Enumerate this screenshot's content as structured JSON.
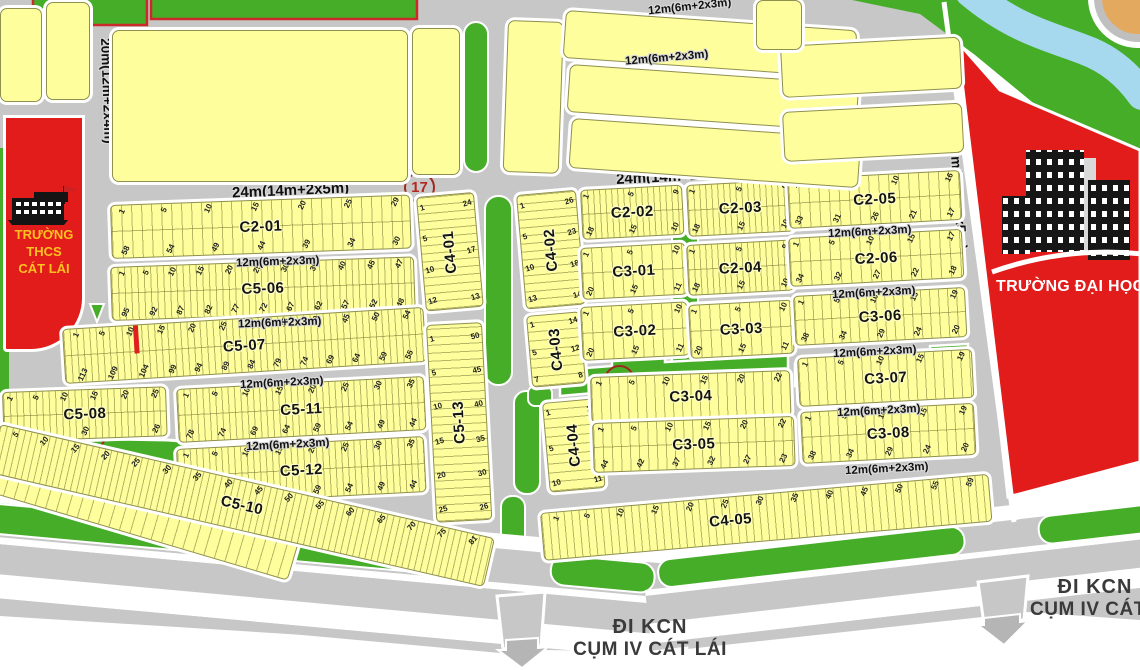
{
  "roads": {
    "r20": "20m(12m+2x4m)",
    "r24": "24m(14m+2x5m)",
    "r23": "23m(13m+2x5m)",
    "r12": "12m(6m+2x3m)",
    "street": "ĐƯỜNG SỐ 15"
  },
  "signs": {
    "kcn_line1": "ĐI KCN",
    "kcn_line2": "CỤM IV CÁT LÁI"
  },
  "schools": {
    "thcs_line1": "TRƯỜNG",
    "thcs_line2": "THCS",
    "thcs_line3": "CÁT LÁI",
    "university": "TRƯỜNG ĐẠI HỌC"
  },
  "marker": {
    "route": "17"
  },
  "colors": {
    "parcel_yellow": "#feff9c",
    "road_gray": "#c7c7c7",
    "green": "#46ad29",
    "red": "#e21b1b",
    "river_blue": "#a6d9ee",
    "sand": "#e3aa5f",
    "school_text": "#ffc21e"
  },
  "blocks": {
    "C2_01": {
      "label": "C2-01",
      "top": [
        1,
        5,
        10,
        15,
        20,
        25,
        29
      ],
      "bottom": [
        58,
        54,
        49,
        44,
        39,
        34,
        30
      ]
    },
    "C5_06": {
      "label": "C5-06",
      "top": [
        1,
        5,
        10,
        15,
        20,
        25,
        30,
        35,
        40,
        45,
        47
      ],
      "bottom": [
        95,
        92,
        87,
        82,
        77,
        72,
        67,
        62,
        57,
        52,
        48
      ]
    },
    "C5_07": {
      "label": "C5-07",
      "top": [
        1,
        5,
        10,
        15,
        20,
        25,
        30,
        35,
        40,
        45,
        50,
        54
      ],
      "bottom": [
        113,
        109,
        104,
        99,
        94,
        89,
        84,
        79,
        74,
        69,
        64,
        59,
        55
      ]
    },
    "C5_08": {
      "label": "C5-08",
      "top": [
        1,
        5,
        10,
        15,
        20,
        25
      ],
      "bottom": [
        34,
        30,
        26
      ]
    },
    "C5_09": {
      "label": "C5-09",
      "nums": [
        1,
        5,
        10,
        15,
        20,
        25,
        27
      ]
    },
    "C5_10": {
      "label": "C5-10",
      "nums": [
        5,
        10,
        15,
        20,
        25,
        30,
        35,
        40,
        45,
        50,
        55,
        60,
        65,
        70,
        75,
        81
      ]
    },
    "C5_11": {
      "label": "C5-11",
      "top": [
        1,
        5,
        10,
        15,
        20,
        25,
        30,
        35
      ],
      "bottom": [
        78,
        74,
        69,
        64,
        59,
        54,
        49,
        44
      ]
    },
    "C5_12": {
      "label": "C5-12",
      "top": [
        1,
        5,
        10,
        15,
        20,
        25,
        30,
        35
      ],
      "bottom": [
        78,
        74,
        69,
        64,
        59,
        54,
        49,
        44
      ]
    },
    "C5_13": {
      "label": "C5-13",
      "left": [
        1,
        5,
        10,
        15,
        20,
        25
      ],
      "right": [
        50,
        45,
        40,
        35,
        30,
        26
      ]
    },
    "C4_01": {
      "label": "C4-01",
      "left": [
        1,
        5,
        10,
        12
      ],
      "right": [
        24,
        17,
        13
      ]
    },
    "C4_02": {
      "label": "C4-02",
      "left": [
        1,
        5,
        10,
        13
      ],
      "right": [
        26,
        23,
        18,
        14
      ]
    },
    "C4_03": {
      "label": "C4-03",
      "left": [
        1,
        5,
        7
      ],
      "right": [
        14,
        12,
        8
      ]
    },
    "C4_04": {
      "label": "C4-04",
      "left": [
        1,
        5,
        10
      ],
      "right": [
        20,
        15,
        11
      ]
    },
    "C4_05": {
      "label": "C4-05",
      "nums": [
        1,
        5,
        10,
        15,
        20,
        25,
        30,
        35,
        40,
        45,
        50,
        55,
        59
      ]
    },
    "C2_02": {
      "label": "C2-02",
      "top": [
        1,
        5,
        9
      ],
      "bottom": [
        18,
        15,
        10
      ]
    },
    "C2_03": {
      "label": "C2-03",
      "top": [
        1,
        5,
        9
      ],
      "bottom": [
        18,
        15,
        10
      ]
    },
    "C2_04": {
      "label": "C2-04",
      "top": [
        1,
        5,
        9
      ],
      "bottom": [
        18,
        15,
        10
      ]
    },
    "C2_05": {
      "label": "C2-05",
      "top": [
        1,
        5,
        10,
        16
      ],
      "bottom": [
        33,
        31,
        26,
        21,
        17
      ]
    },
    "C2_06": {
      "label": "C2-06",
      "top": [
        1,
        5,
        10,
        15,
        17
      ],
      "bottom": [
        34,
        32,
        27,
        22,
        18
      ]
    },
    "C3_01": {
      "label": "C3-01",
      "top": [
        1,
        5,
        10
      ],
      "bottom": [
        20,
        15,
        11
      ]
    },
    "C3_02": {
      "label": "C3-02",
      "top": [
        1,
        5,
        10
      ],
      "bottom": [
        20,
        15,
        11
      ]
    },
    "C3_03": {
      "label": "C3-03",
      "top": [
        1,
        5,
        10
      ],
      "bottom": [
        20,
        15,
        11
      ]
    },
    "C3_04": {
      "label": "C3-04",
      "nums": [
        1,
        5,
        10,
        15,
        20,
        22
      ]
    },
    "C3_05": {
      "label": "C3-05",
      "top": [
        1,
        5,
        10,
        15,
        20,
        22
      ],
      "bottom": [
        44,
        42,
        37,
        32,
        27,
        23
      ]
    },
    "C3_06": {
      "label": "C3-06",
      "top": [
        1,
        5,
        10,
        15,
        19
      ],
      "bottom": [
        38,
        34,
        29,
        24,
        20
      ]
    },
    "C3_07": {
      "label": "C3-07",
      "nums": [
        1,
        5,
        10,
        15,
        19
      ]
    },
    "C3_08": {
      "label": "C3-08",
      "top": [
        1,
        5,
        10,
        15,
        19
      ],
      "bottom": [
        38,
        34,
        29,
        24,
        20
      ]
    }
  }
}
